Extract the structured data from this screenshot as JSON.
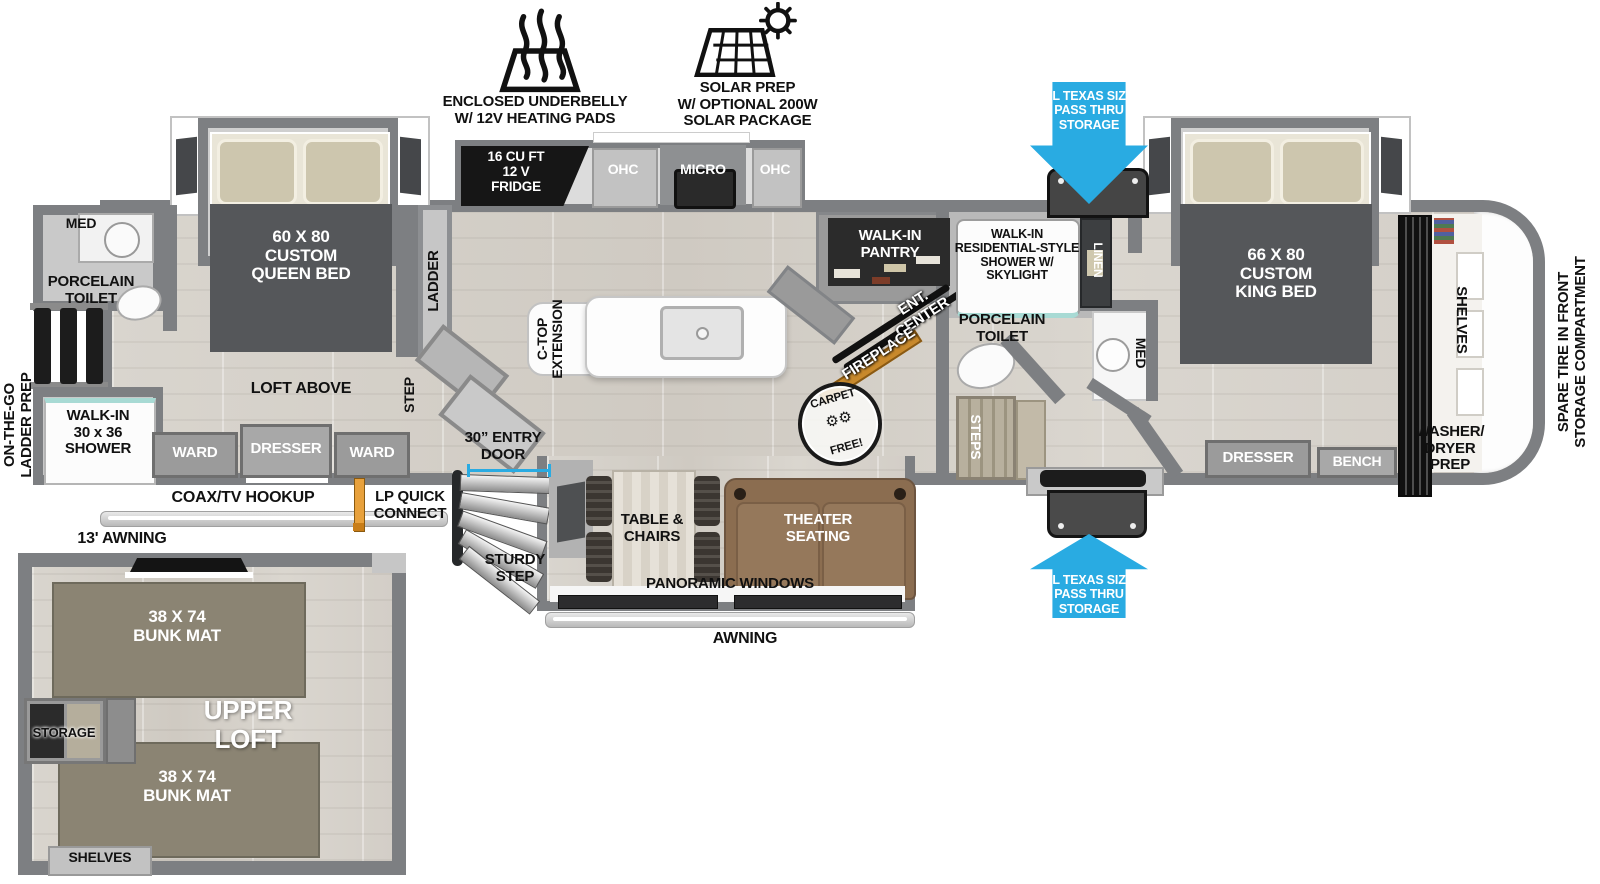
{
  "callouts": {
    "underbelly": "ENCLOSED UNDERBELLY\nW/ 12V HEATING PADS",
    "solar": "SOLAR PREP\nW/ OPTIONAL 200W\nSOLAR PACKAGE",
    "pass_thru_top": "XL TEXAS SIZE\nPASS THRU\nSTORAGE",
    "pass_thru_bottom": "XL TEXAS SIZE\nPASS THRU\nSTORAGE",
    "spare_tire": "SPARE TIRE IN FRONT\nSTORAGE COMPARTMENT",
    "awning_13": "13' AWNING",
    "awning": "AWNING",
    "coax": "COAX/TV HOOKUP",
    "lp_quick": "LP QUICK\nCONNECT",
    "on_the_go": "ON-THE-GO\nLADDER PREP",
    "entry_door": "30” ENTRY\nDOOR",
    "sturdy_step": "STURDY\nSTEP",
    "carpet_free_top": "CARPET",
    "carpet_free_bottom": "FREE!"
  },
  "rear_bath": {
    "med": "MED",
    "toilet": "PORCELAIN\nTOILET",
    "shower": "WALK-IN\n30 x 36\nSHOWER"
  },
  "rear_bedroom": {
    "bed": "60 X 80\nCUSTOM\nQUEEN BED",
    "loft_above": "LOFT ABOVE",
    "ward_l": "WARD",
    "dresser": "DRESSER",
    "ward_r": "WARD",
    "ladder": "LADDER",
    "step": "STEP"
  },
  "kitchen": {
    "fridge": "16 CU FT\n12 V\nFRIDGE",
    "ohc_l": "OHC",
    "micro": "MICRO",
    "ohc_r": "OHC",
    "ctop": "C-TOP\nEXTENSION",
    "pantry": "WALK-IN\nPANTRY",
    "ent_center": "ENT.\nCENTER",
    "fireplace": "FIREPLACE"
  },
  "front_bath": {
    "shower": "WALK-IN\nRESIDENTIAL-STYLE\nSHOWER W/\nSKYLIGHT",
    "linen": "LINEN",
    "toilet": "PORCELAIN\nTOILET",
    "med": "MED",
    "steps": "STEPS"
  },
  "front_bedroom": {
    "bed": "66 X 80\nCUSTOM\nKING BED",
    "dresser": "DRESSER",
    "bench": "BENCH",
    "shelves": "SHELVES",
    "washer_dryer": "WASHER/\nDRYER\nPREP"
  },
  "living": {
    "table_chairs": "TABLE &\nCHAIRS",
    "theater": "THEATER\nSEATING",
    "panoramic": "PANORAMIC WINDOWS"
  },
  "loft": {
    "bunk_top": "38 X 74\nBUNK MAT",
    "bunk_bottom": "38 X 74\nBUNK MAT",
    "upper_loft": "UPPER\nLOFT",
    "storage": "STORAGE",
    "shelves": "SHELVES"
  },
  "colors": {
    "arrow_blue": "#29abe2",
    "wall_gray": "#7d7f82",
    "floor": "#d6d2cb",
    "furniture_dark": "#55575a",
    "sofa_brown": "#8b6d50",
    "bunk_olive": "#8b8473",
    "fireplace_gold": "#c8892c",
    "shower_teal": "#a8dad4"
  }
}
